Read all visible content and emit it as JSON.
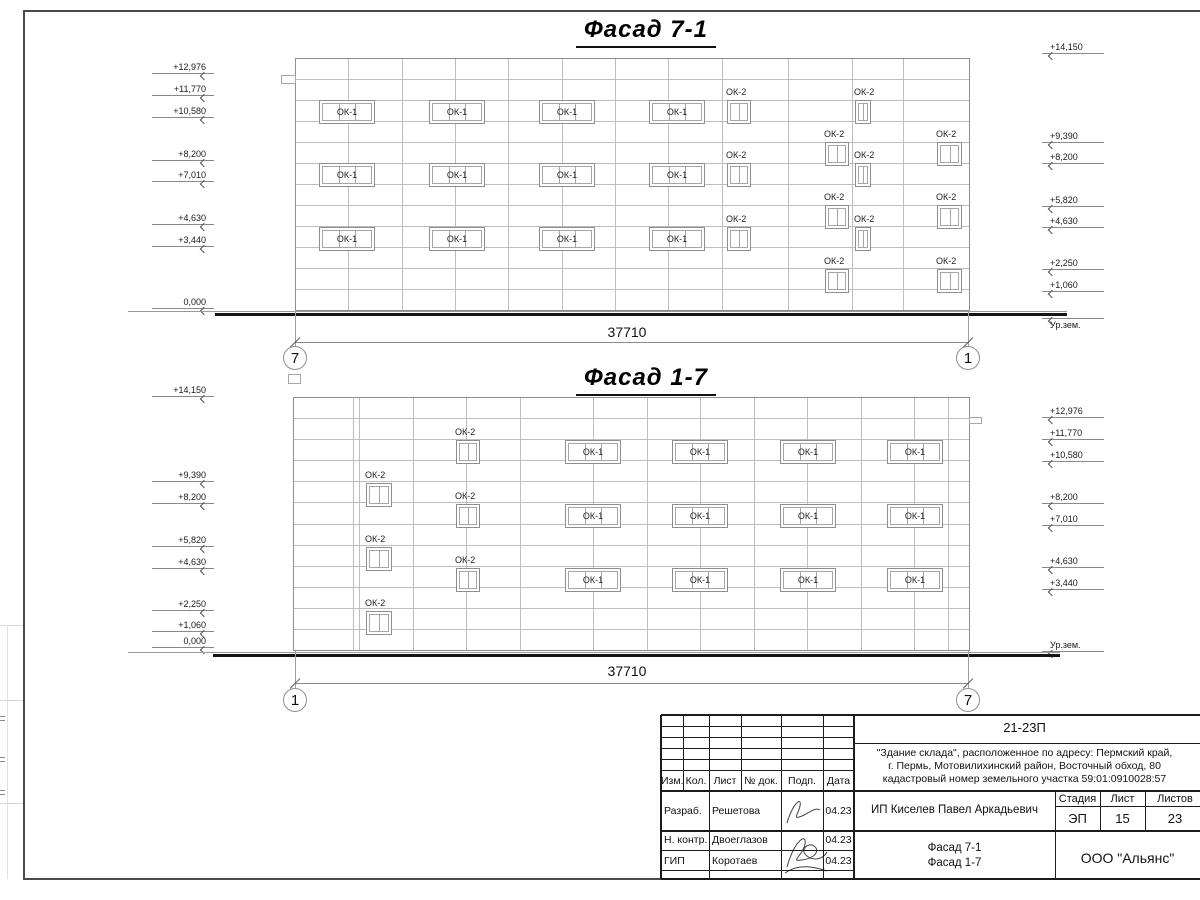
{
  "facades": [
    {
      "key": "fasad-7-1",
      "title": "Фасад 7-1",
      "title_x": 646,
      "title_y": 16,
      "box": {
        "left": 295,
        "top": 58,
        "right": 970,
        "bottom": 311,
        "rows": 12
      },
      "verticals": [
        348,
        402,
        455,
        508,
        562,
        615,
        668,
        722,
        788,
        852,
        903
      ],
      "tabs": [
        {
          "x": 281,
          "y": 75,
          "w": 15,
          "h": 9
        }
      ],
      "ok1": {
        "label": "ОК-1",
        "w": 56,
        "h": 24,
        "panes": 3,
        "cols": [
          319,
          429,
          539,
          649
        ],
        "rows": [
          100,
          163,
          227
        ]
      },
      "ok2": {
        "label": "ОК-2",
        "h": 24,
        "panes": 2,
        "cols": [
          {
            "x": 727,
            "w": 24,
            "rows": [
              100,
              163,
              227
            ]
          },
          {
            "x": 825,
            "w": 24,
            "rows": [
              142,
              205,
              269
            ]
          },
          {
            "x": 855,
            "w": 16,
            "rows": [
              100,
              163,
              227
            ]
          },
          {
            "x": 937,
            "w": 25,
            "rows": [
              142,
              205,
              269
            ]
          }
        ]
      },
      "marks_left": [
        {
          "t": "+12,976",
          "y": 73
        },
        {
          "t": "+11,770",
          "y": 95
        },
        {
          "t": "+10,580",
          "y": 117
        },
        {
          "t": "+8,200",
          "y": 160
        },
        {
          "t": "+7,010",
          "y": 181
        },
        {
          "t": "+4,630",
          "y": 224
        },
        {
          "t": "+3,440",
          "y": 246
        },
        {
          "t": "0,000",
          "y": 308
        }
      ],
      "marks_right": [
        {
          "t": "+14,150",
          "y": 53
        },
        {
          "t": "+9,390",
          "y": 142
        },
        {
          "t": "+8,200",
          "y": 163
        },
        {
          "t": "+5,820",
          "y": 206
        },
        {
          "t": "+4,630",
          "y": 227
        },
        {
          "t": "+2,250",
          "y": 269
        },
        {
          "t": "+1,060",
          "y": 291
        },
        {
          "t": "Ур.зем.",
          "y": 318,
          "below": true
        }
      ],
      "ground": {
        "thin_y": 311,
        "thick_y": 313,
        "x1": 128,
        "thick_x1": 215,
        "x2": 1067
      },
      "dim": {
        "y": 342,
        "x1": 295,
        "x2": 968,
        "text": "37710",
        "text_x": 627,
        "text_y": 324
      },
      "axes": [
        {
          "t": "7",
          "x": 295,
          "cy": 358
        },
        {
          "t": "1",
          "x": 968,
          "cy": 358
        }
      ]
    },
    {
      "key": "fasad-1-7",
      "title": "Фасад 1-7",
      "title_x": 646,
      "title_y": 364,
      "box": {
        "left": 293,
        "top": 397,
        "right": 970,
        "bottom": 651,
        "rows": 12
      },
      "verticals": [
        353,
        359,
        413,
        466,
        520,
        593,
        647,
        700,
        754,
        807,
        861,
        914,
        948
      ],
      "tabs": [
        {
          "x": 288,
          "y": 374,
          "w": 13,
          "h": 10
        },
        {
          "x": 969,
          "y": 417,
          "w": 13,
          "h": 7
        }
      ],
      "ok1": {
        "label": "ОК-1",
        "w": 56,
        "h": 24,
        "panes": 3,
        "cols": [
          565,
          672,
          780,
          887
        ],
        "rows": [
          440,
          504,
          568
        ]
      },
      "ok2": {
        "label": "ОК-2",
        "h": 24,
        "panes": 2,
        "cols": [
          {
            "x": 366,
            "w": 26,
            "rows": [
              483,
              547,
              611
            ]
          },
          {
            "x": 456,
            "w": 24,
            "rows": [
              440,
              504,
              568
            ]
          }
        ]
      },
      "marks_left": [
        {
          "t": "+14,150",
          "y": 396
        },
        {
          "t": "+9,390",
          "y": 481
        },
        {
          "t": "+8,200",
          "y": 503
        },
        {
          "t": "+5,820",
          "y": 546
        },
        {
          "t": "+4,630",
          "y": 568
        },
        {
          "t": "+2,250",
          "y": 610
        },
        {
          "t": "+1,060",
          "y": 631
        },
        {
          "t": "0,000",
          "y": 647
        }
      ],
      "marks_right": [
        {
          "t": "+12,976",
          "y": 417
        },
        {
          "t": "+11,770",
          "y": 439
        },
        {
          "t": "+10,580",
          "y": 461
        },
        {
          "t": "+8,200",
          "y": 503
        },
        {
          "t": "+7,010",
          "y": 525
        },
        {
          "t": "+4,630",
          "y": 567
        },
        {
          "t": "+3,440",
          "y": 589
        },
        {
          "t": "Ур.зем.",
          "y": 651
        }
      ],
      "ground": {
        "thin_y": 652,
        "thick_y": 654,
        "x1": 128,
        "thick_x1": 213,
        "x2": 1060
      },
      "dim": {
        "y": 683,
        "x1": 295,
        "x2": 968,
        "text": "37710",
        "text_x": 627,
        "text_y": 663
      },
      "axes": [
        {
          "t": "1",
          "x": 295,
          "cy": 700
        },
        {
          "t": "7",
          "x": 968,
          "cy": 700
        }
      ]
    }
  ],
  "titleblock": {
    "doc_number": "21-23П",
    "address_lines": [
      "\"Здание склада\", расположенное по адресу: Пермский край,",
      "г. Пермь, Мотовилихинский район, Восточный обход, 80",
      "кадастровый номер земельного участка 59:01:0910028:57"
    ],
    "client": "ИП Киселев Павел Аркадьевич",
    "sheet_title_line1": "Фасад 7-1",
    "sheet_title_line2": "Фасад 1-7",
    "company": "ООО \"Альянс\"",
    "stage_label": "Стадия",
    "sheet_label": "Лист",
    "sheets_label": "Листов",
    "stage": "ЭП",
    "sheet": "15",
    "sheets": "23",
    "columns": [
      "Изм.",
      "Кол.",
      "Лист",
      "№ док.",
      "Подп.",
      "Дата"
    ],
    "rows": [
      {
        "role": "Разраб.",
        "name": "Решетова",
        "date": "04.23"
      },
      {
        "role": "Н. контр.",
        "name": "Двоеглазов",
        "date": "04.23"
      },
      {
        "role": "ГИП",
        "name": "Коротаев",
        "date": "04.23"
      }
    ]
  }
}
